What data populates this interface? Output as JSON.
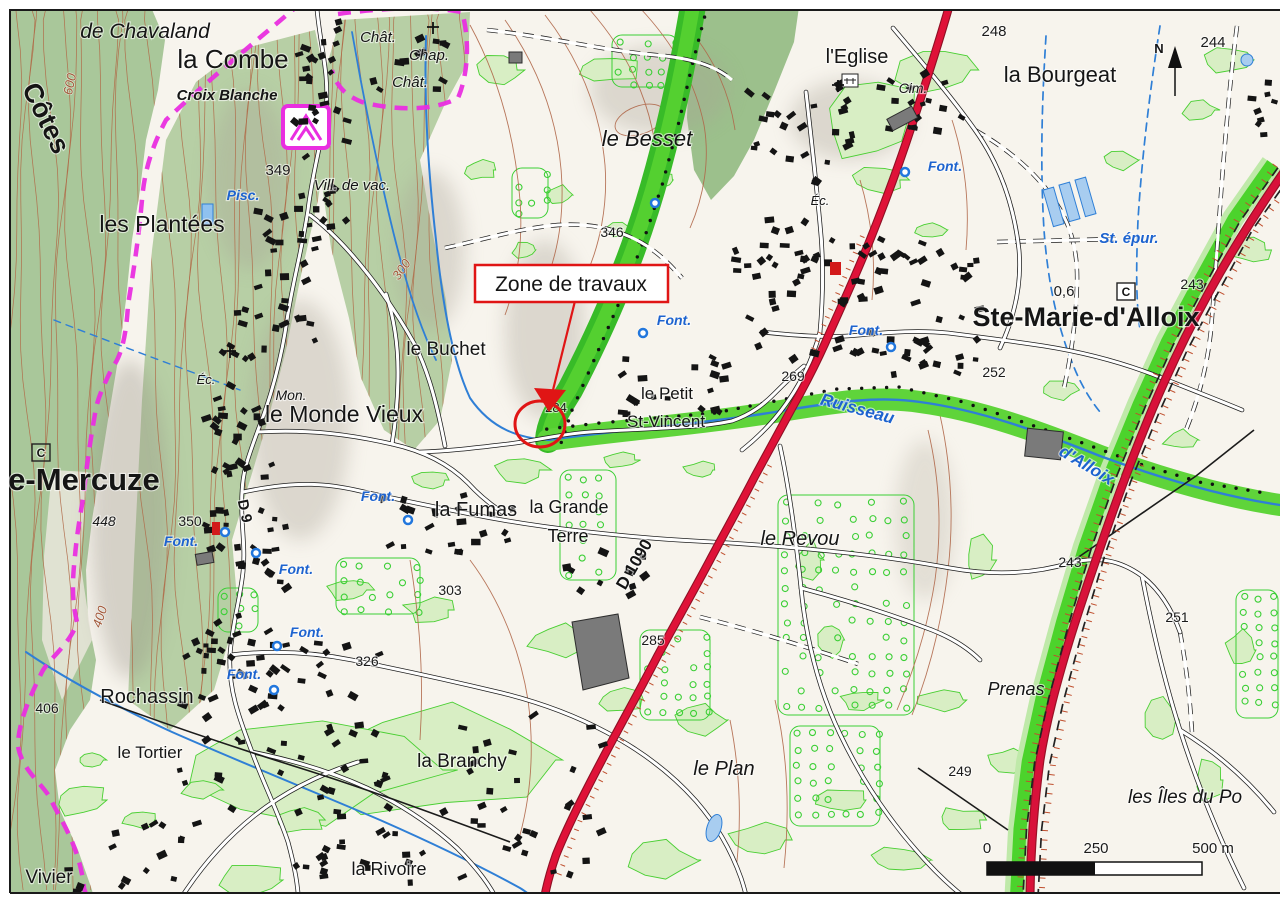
{
  "labels": {
    "de_chavaland": "de Chavaland",
    "la_combe": "la Combe",
    "croix_blanche": "Croix Blanche",
    "cotes": "Côtes",
    "les_plantees": "les Plantées",
    "pisc": "Pisc.",
    "n349": "349",
    "vill_de_vac": "Vill. de vac.",
    "chat1": "Chât.",
    "chap": "Chap.",
    "chat2": "Chât.",
    "le_besset": "le Besset",
    "n346": "346",
    "l_eglise": "l'Eglise",
    "cim": "Cim.",
    "n248": "248",
    "la_bourgeat": "la Bourgeat",
    "n244": "244",
    "font_bourgeat": "Font.",
    "st_epur": "St. épur.",
    "n0_6": "0,6",
    "c_right": "C",
    "n243_right": "243",
    "ste_marie": "Ste-Marie-d'Alloix",
    "n252": "252",
    "le_buchet": "le Buchet",
    "n300": "300",
    "n400": "400",
    "n600": "600",
    "font_petit": "Font.",
    "n284": "284",
    "le_petit": "le Petit",
    "st_vincent": "St-Vincent",
    "ruisseau": "Ruisseau",
    "d_alloix": "d'Alloix",
    "n269": "269",
    "mon": "Mon.",
    "le_monde_vieux": "le Monde Vieux",
    "mercuze": "e-Mercuze",
    "n448": "448",
    "n350": "350",
    "font_mercuze": "Font.",
    "d9": "D 9",
    "c_left": "C",
    "font_2": "Font.",
    "font_3": "Font.",
    "font_4": "Font.",
    "n326": "326",
    "n406": "406",
    "rochassin": "Rochassin",
    "le_tortier": "le Tortier",
    "vivier": "Vivier",
    "font_fumas": "Font.",
    "la_fumas": "la Fumas",
    "la_grande": "la Grande",
    "terre": "Terre",
    "n303": "303",
    "d1090": "D 1090",
    "n285": "285",
    "la_branchy": "la Branchy",
    "la_rivoire": "la Rivoire",
    "le_plan": "le Plan",
    "le_revou": "le Revou",
    "prenas": "Prenas",
    "n243_junction": "243",
    "n251": "251",
    "n249": "249",
    "les_iles": "les Îles du Po",
    "font_eglise": "Font.",
    "ec_mercuze": "Éc.",
    "ec_ste_marie": "Éc."
  },
  "callout": {
    "text": "Zone de travaux"
  },
  "compass": {
    "label": "N"
  },
  "scale_bar": {
    "tick_0": "0",
    "tick_250": "250",
    "tick_500": "500 m"
  },
  "colors": {
    "road_major_red": "#dc1238",
    "motorway_red": "#d8123a",
    "trail_magenta": "#e92ee0",
    "water_blue": "#2f7fd6",
    "vegetation_green": "#52cd2e",
    "forest_green": "#a9c79a",
    "contour_brown": "#b0684a",
    "annotation_red": "#e01515"
  }
}
